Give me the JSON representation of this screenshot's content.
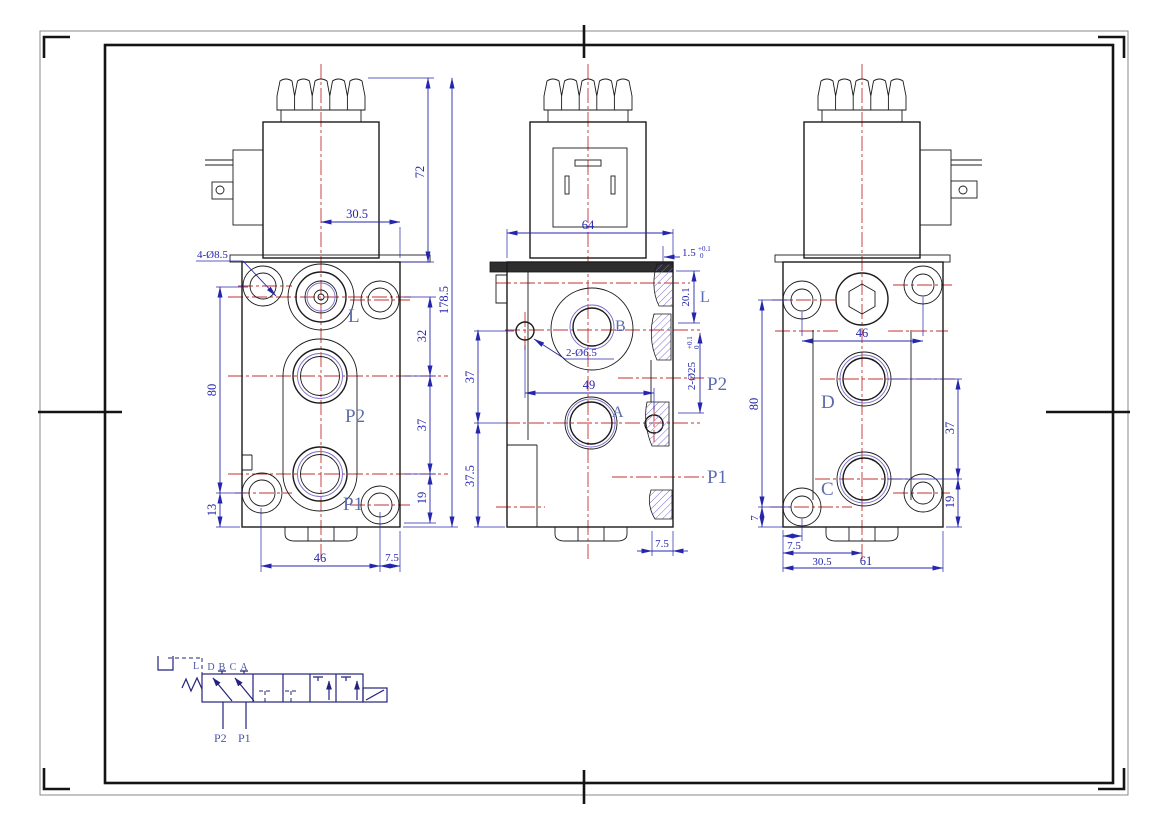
{
  "colors": {
    "outline_black": "#1b1b1b",
    "centerline_red": "#c53030",
    "dimension_blue": "#2626ad",
    "port_label_blue": "#5b6cae",
    "hatch_violet": "#7b6fd0",
    "schematic_navy": "#23237d"
  },
  "front_view": {
    "callout_holes": "4-Ø8.5",
    "labels": {
      "l": "L",
      "p2": "P2",
      "p1": "P1"
    },
    "dims": {
      "center_to_edge": "30.5",
      "coil_height": "72",
      "overall_height": "178.5",
      "l_to_p2": "32",
      "p2_to_p1": "37",
      "p1_to_bottom": "19",
      "hole_span_vertical": "80",
      "bottom_offset": "13",
      "hole_span_horizontal": "46",
      "edge_offset": "7.5"
    }
  },
  "side_view": {
    "callout_holes": "2-Ø6.5",
    "labels": {
      "l": "L",
      "b": "B",
      "a": "A",
      "p2": "P2",
      "p1": "P1"
    },
    "dims": {
      "body_width": "64",
      "step": "1.5",
      "step_tol_upper": "+0.1",
      "step_tol_lower": "0",
      "l_port_depth": "20.1",
      "port_bore": "2-Ø25",
      "bore_tol_upper": "+0.1",
      "bore_tol_lower": "0",
      "hole_to_hole": "49",
      "b_to_a": "37",
      "a_to_bottom": "37.5",
      "bottom_step": "7.5"
    }
  },
  "rear_view": {
    "labels": {
      "d": "D",
      "c": "C"
    },
    "dims": {
      "hole_span_horizontal": "46",
      "d_to_c": "37",
      "c_to_bottom": "19",
      "hole_span_vertical": "80",
      "bottom_offset": "7",
      "edge_offset": "7.5",
      "center_offset": "30.5",
      "overall_width": "61"
    }
  },
  "schematic": {
    "drain_label": "L",
    "port_labels": [
      "D",
      "B",
      "C",
      "A"
    ],
    "p2": "P2",
    "p1": "P1"
  }
}
